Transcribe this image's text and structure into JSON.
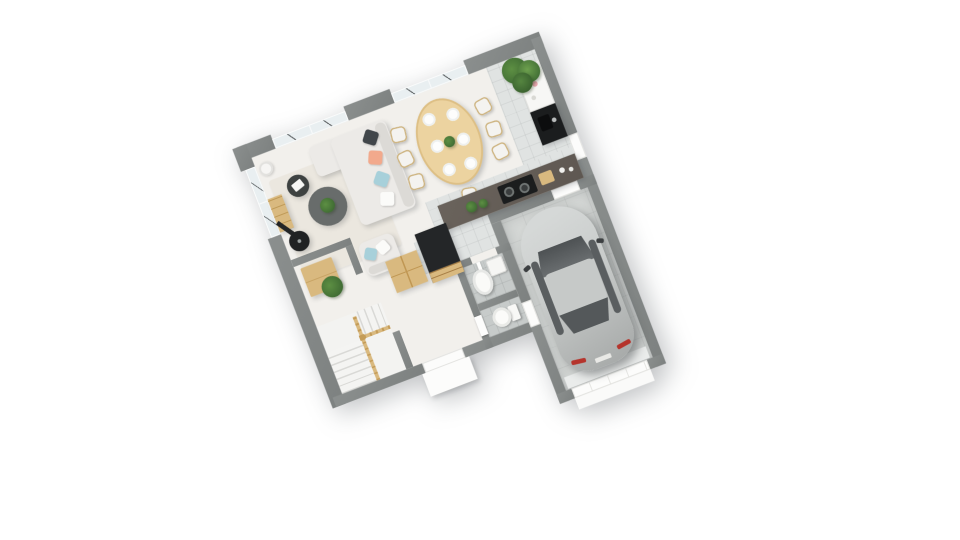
{
  "scene": {
    "label": "3D isometric floor plan render — ground floor of a house with attached garage",
    "background": "#ffffff"
  },
  "palette": {
    "wall": "#8b8f8e",
    "wallDark": "#7d8180",
    "floorWood": "#f2f0ec",
    "tile": "#e0e3e2",
    "tileBath": "#c7cbca",
    "floorGarage": "#d4d7d5",
    "rug": "#ebe7df",
    "glass": "#e9eff1",
    "wood": "#d9b97f",
    "woodTable": "#ecd3a0",
    "sofa": "#eceae7",
    "pillowDark": "#41464a",
    "pillowPeach": "#f2a98c",
    "pillowBlue": "#a7d0da",
    "pillowWhite": "#fbfbf9",
    "counter": "#5e5751",
    "black": "#1b1d1e",
    "carBody": "#c9cccb",
    "carShade": "#a9acab",
    "carGlass": "#54585a",
    "tailLight": "#b5342c",
    "plant": "#5d8f43",
    "plantDark": "#3f6b33"
  },
  "rooms": {
    "living": {
      "label": "Living room"
    },
    "dining": {
      "label": "Dining area"
    },
    "kitchen": {
      "label": "Kitchen"
    },
    "garage": {
      "label": "Garage"
    },
    "entry": {
      "label": "Entry hall"
    },
    "bath": {
      "label": "Bathroom"
    },
    "wc": {
      "label": "WC"
    },
    "stairs": {
      "label": "Staircase"
    },
    "closet": {
      "label": "Storage closet"
    }
  },
  "furniture": {
    "sofa": {
      "label": "Corner sofa with cushions"
    },
    "armchair": {
      "label": "Armchair with cushions"
    },
    "coffee_table": {
      "label": "Round coffee table with plant"
    },
    "side_table": {
      "label": "Round side table"
    },
    "bookshelf": {
      "label": "Wooden shelf unit"
    },
    "stove": {
      "label": "Wood-burning stove"
    },
    "lamp": {
      "label": "Floor lamp"
    },
    "rug": {
      "label": "Area rug"
    },
    "dining_table": {
      "label": "Oval wooden dining table"
    },
    "dining_chair": {
      "label": "Dining chair"
    },
    "plate": {
      "label": "Place setting"
    },
    "centerpiece": {
      "label": "Green centerpiece"
    },
    "console": {
      "label": "Kitchen console with accessories"
    },
    "sink": {
      "label": "Kitchen sink unit"
    },
    "hob": {
      "label": "Cooktop with pans"
    },
    "counter": {
      "label": "Kitchen counter"
    },
    "fridge": {
      "label": "Tall fridge / oven column"
    },
    "hall_cabinet": {
      "label": "Hall cabinet"
    },
    "plant_large": {
      "label": "Large potted plant"
    },
    "plant_small": {
      "label": "Small floor plant"
    },
    "bench": {
      "label": "Closet bench"
    },
    "washbasin": {
      "label": "Washbasin"
    },
    "washer": {
      "label": "Washing machine"
    },
    "toilet": {
      "label": "Toilet"
    },
    "car": {
      "label": "Parked car"
    },
    "garage_door": {
      "label": "Garage sectional door"
    },
    "front_door": {
      "label": "Front entry door with porch"
    },
    "back_door": {
      "label": "Back door"
    },
    "window": {
      "label": "Window"
    },
    "porch": {
      "label": "Entry porch slab"
    }
  },
  "counts": {
    "dining_plates": 6,
    "dining_chairs": 7,
    "window_groups": 3,
    "stair_flights": 2
  }
}
